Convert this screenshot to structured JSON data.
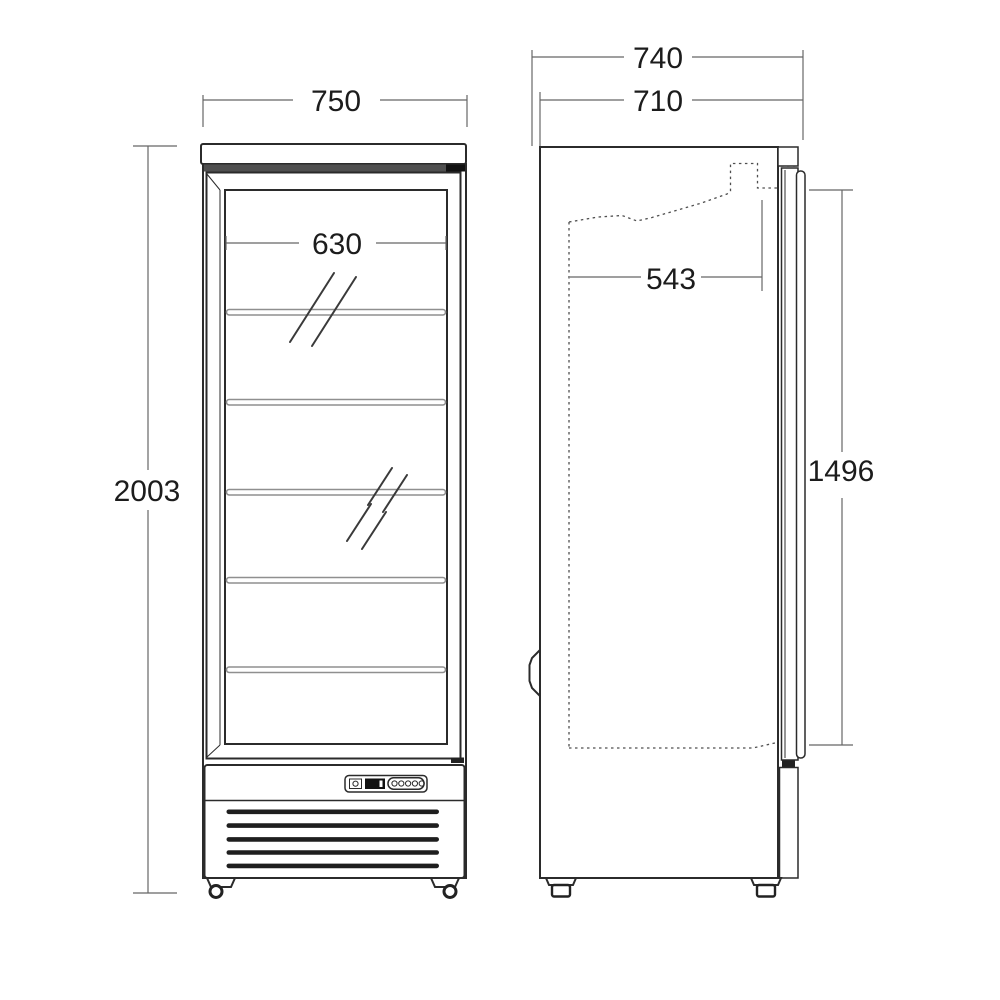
{
  "views": {
    "front": {
      "dims": {
        "overall_width": "750",
        "glass_interior_width": "630",
        "overall_height": "2003"
      },
      "shelf_count": 5
    },
    "side": {
      "dims": {
        "overall_depth": "740",
        "cabinet_depth": "710",
        "interior_depth": "543",
        "door_glass_height": "1496"
      }
    }
  },
  "colors": {
    "background": "#ffffff",
    "outline": "#2b2b2b",
    "dimension_line": "#666666",
    "dimension_text": "#1c1c1c",
    "shelf": "#8f8f8f",
    "top_strip": "#4f4f4f",
    "grille_bar": "#1e1e1e"
  }
}
